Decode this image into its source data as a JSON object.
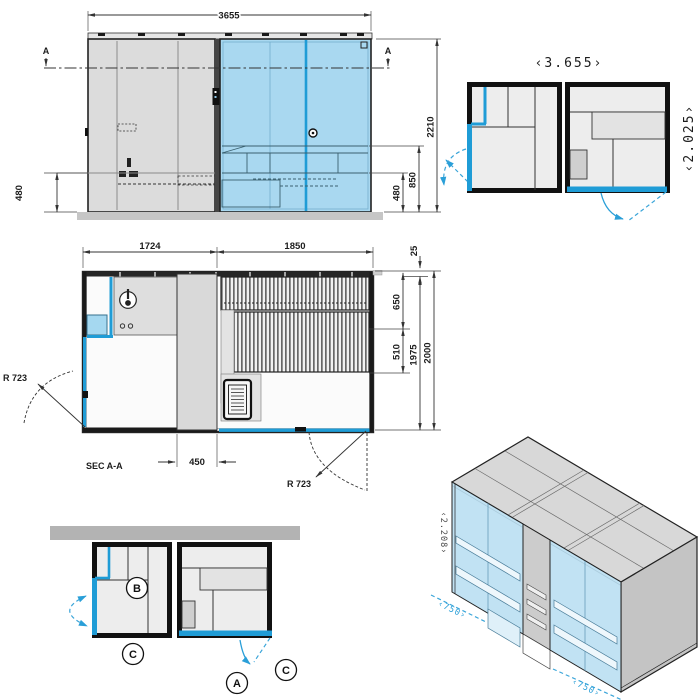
{
  "colors": {
    "accent_blue": "#1f9cd6",
    "glass_fill": "#a9d8f0",
    "panel_gray": "#dcdcdc",
    "wall_black": "#1a1a1a",
    "dim_line": "#333333"
  },
  "elevation": {
    "section_marker_left": "A",
    "section_marker_right": "A",
    "dim_width": "3655",
    "dim_height": "2210",
    "dim_bench_high": "850",
    "dim_bench_low": "480",
    "dim_base_left": "480"
  },
  "plan": {
    "title": "SEC A-A",
    "dim_room_left": "1724",
    "dim_room_right": "1850",
    "dim_wall_offset": "25",
    "dim_bench_depth_1": "650",
    "dim_bench_depth_2": "510",
    "dim_depth_inner": "1975",
    "dim_depth_outer": "2000",
    "dim_column": "450",
    "radius_left": "R 723",
    "radius_right": "R 723"
  },
  "layout_plan": {
    "dim_width": "‹3.655›",
    "dim_depth": "‹2.025›"
  },
  "site_plan": {
    "balloon_b": "B",
    "balloon_c1": "C",
    "balloon_a": "A",
    "balloon_c2": "C"
  },
  "isometric": {
    "dim_height": "‹2.208›",
    "dim_module_left": "‹750›",
    "dim_module_right": "‹750›"
  }
}
